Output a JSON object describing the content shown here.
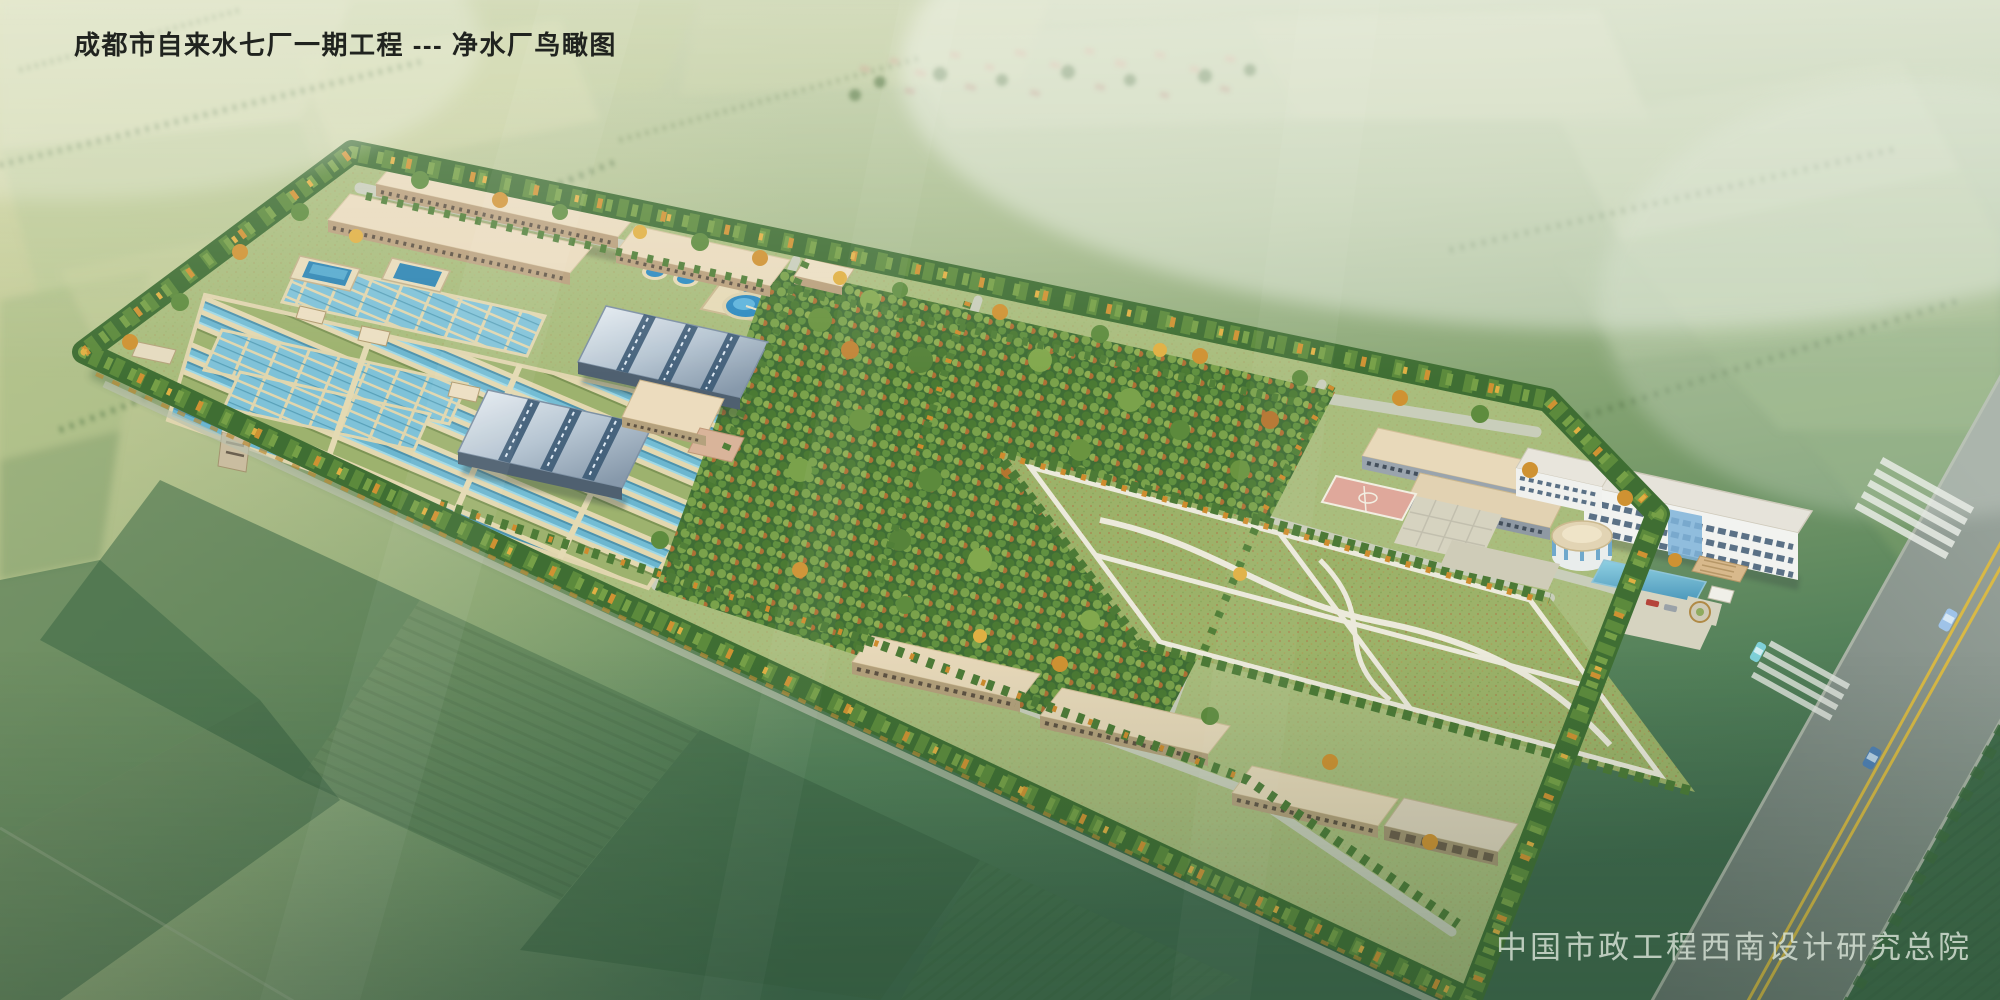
{
  "header": {
    "title": "成都市自来水七厂一期工程 --- 净水厂鸟瞰图"
  },
  "footer": {
    "credit": "中国市政工程西南设计研究总院"
  },
  "scene": {
    "description": "Aerial architectural rendering of a water purification plant surrounded by farmland",
    "palette": {
      "haze": "#ccd8c2",
      "farmland_yellow_green": "#c6cf9f",
      "farmland_green": "#7fa06c",
      "farmland_dark_green": "#3f6a4d",
      "site_grass": "#a9bd7d",
      "tree_green": "#4e7c38",
      "tree_autumn_orange": "#d09032",
      "basin_water_blue": "#74bdd4",
      "clarifier_water_blue": "#2e8bc0",
      "walkway_beige": "#e3d8b2",
      "building_roof_beige": "#eadbbd",
      "metal_roof_steel_blue": "#aebfcf",
      "road_gray": "#76817b",
      "road_line_yellow": "#d9b945",
      "lawn_green": "#9cb269",
      "court_pink": "#dfa89b",
      "office_white": "#f2f3f0"
    }
  }
}
